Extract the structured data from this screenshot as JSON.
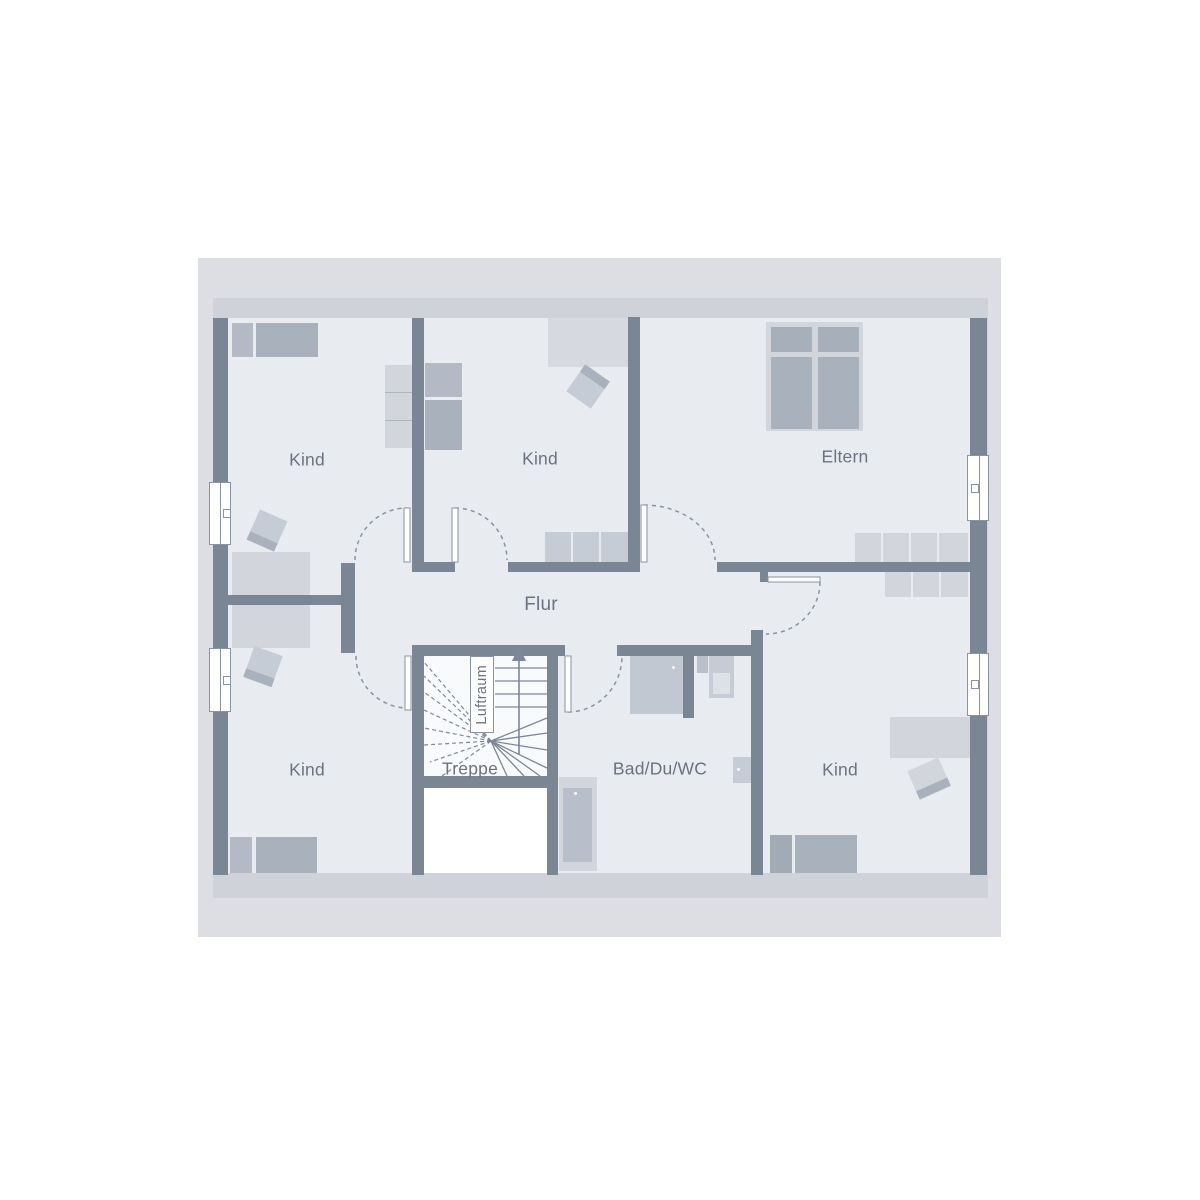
{
  "plan": {
    "title": "Grundriss Dachgeschoss",
    "rooms": {
      "kind_top_left": {
        "label": "Kind"
      },
      "kind_top_middle": {
        "label": "Kind"
      },
      "eltern": {
        "label": "Eltern"
      },
      "flur": {
        "label": "Flur"
      },
      "kind_bottom_left": {
        "label": "Kind"
      },
      "treppe": {
        "label": "Treppe"
      },
      "luftraum": {
        "label": "Luftraum"
      },
      "bad": {
        "label": "Bad/Du/WC"
      },
      "kind_bottom_right": {
        "label": "Kind"
      }
    },
    "icons": {
      "stairs_direction_arrow": "up-arrow"
    },
    "colors": {
      "wall": "#7b8694",
      "roof_outer": "#dcdee3",
      "roof_inner": "#cfd2d9",
      "floor": "#e8ebf0",
      "stair_floor": "#f8fafb",
      "void": "#ffffff",
      "furniture_light": "#d2d6dc",
      "furniture_mid": "#c6ccd5",
      "furniture_dark": "#a9b1bd",
      "furniture_med2": "#b3bac5",
      "line": "#8a93a0",
      "label_text": "#6b7380"
    }
  }
}
